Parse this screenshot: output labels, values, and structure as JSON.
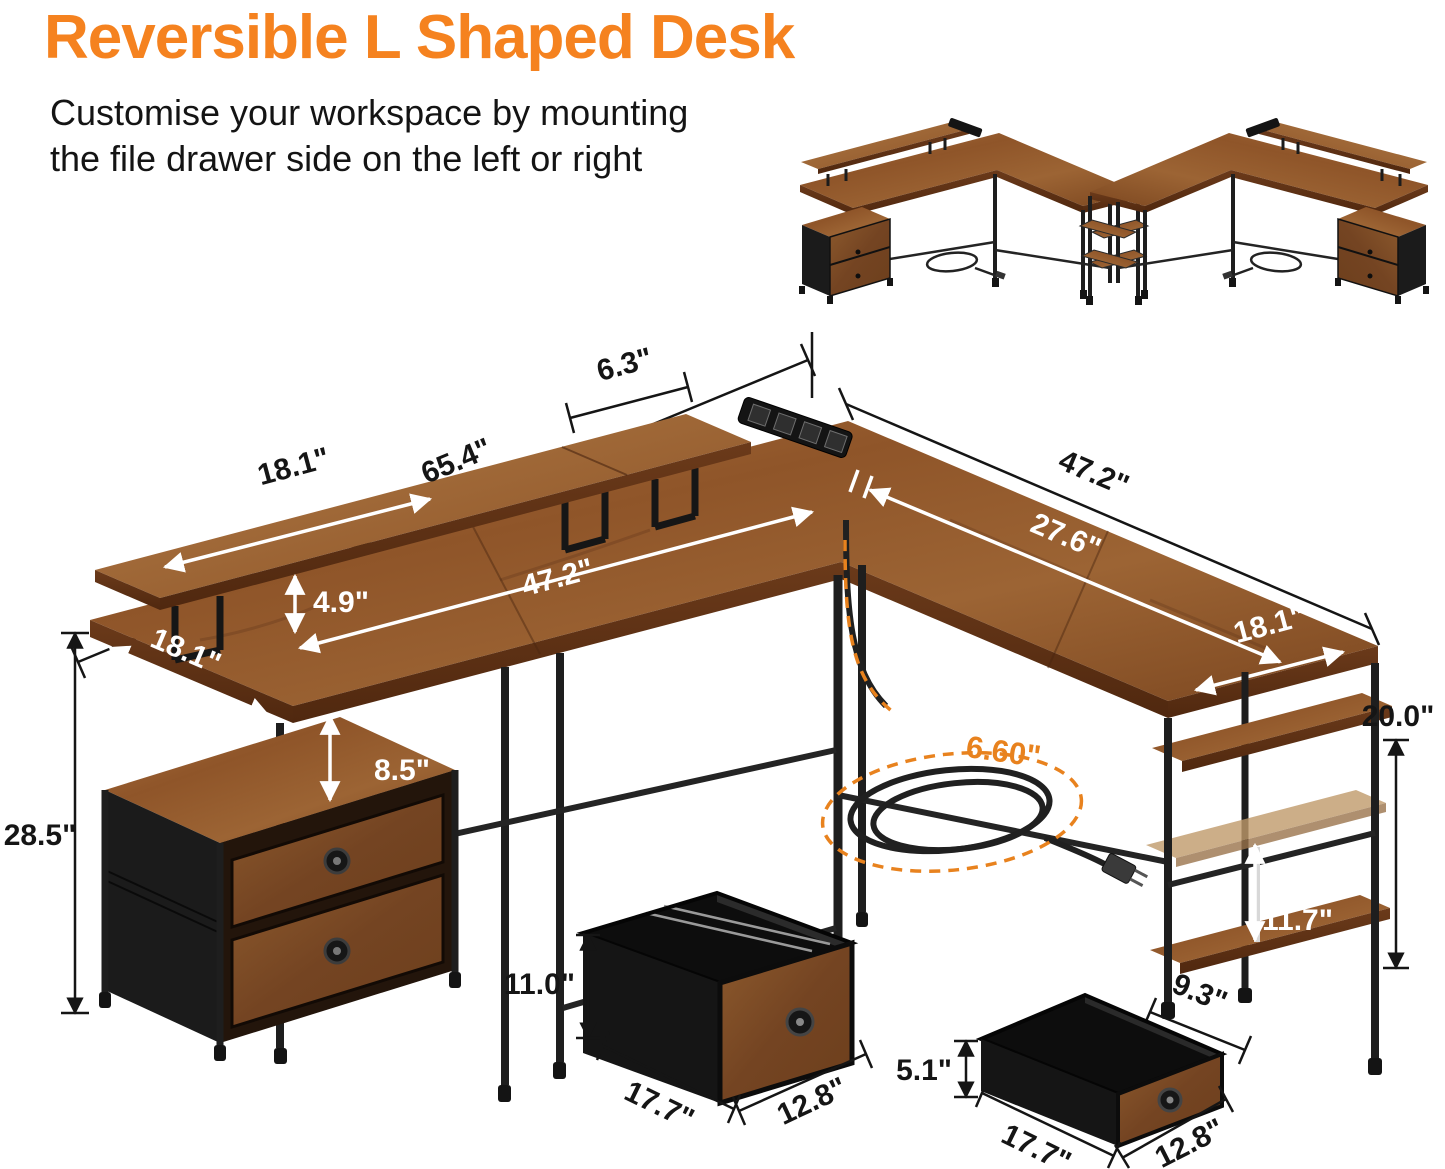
{
  "header": {
    "title": "Reversible L Shaped Desk",
    "subtitle_line1": "Customise your workspace by mounting",
    "subtitle_line2": "the file drawer side on the left or right"
  },
  "colors": {
    "accent_orange": "#F5821F",
    "cord_orange": "#E8821E",
    "dim_text": "#151515",
    "white_dim_text": "#FFFFFF",
    "wood": "#9A6234",
    "metal": "#1C1C1C"
  },
  "dims": {
    "back_total": "65.4\"",
    "riser_segment": "6.3\"",
    "right_wing_top": "47.2\"",
    "riser_length": "18.1\"",
    "riser_height": "4.9\"",
    "desk_length": "47.2\"",
    "right_inner_length": "27.6\"",
    "right_wing_depth": "18.1\"",
    "left_wing_depth": "18.1\"",
    "hutch_gap": "8.5\"",
    "overall_height": "28.5\"",
    "tower_height": "20.0\"",
    "shelf_gap": "11.7\"",
    "shelf_depth": "9.3\"",
    "cord_length": "6.60\"",
    "file_drawer_height": "11.0\"",
    "file_drawer_width": "17.7\"",
    "file_drawer_depth": "12.8\"",
    "small_drawer_height": "5.1\"",
    "small_drawer_width": "17.7\"",
    "small_drawer_depth": "12.8\""
  }
}
